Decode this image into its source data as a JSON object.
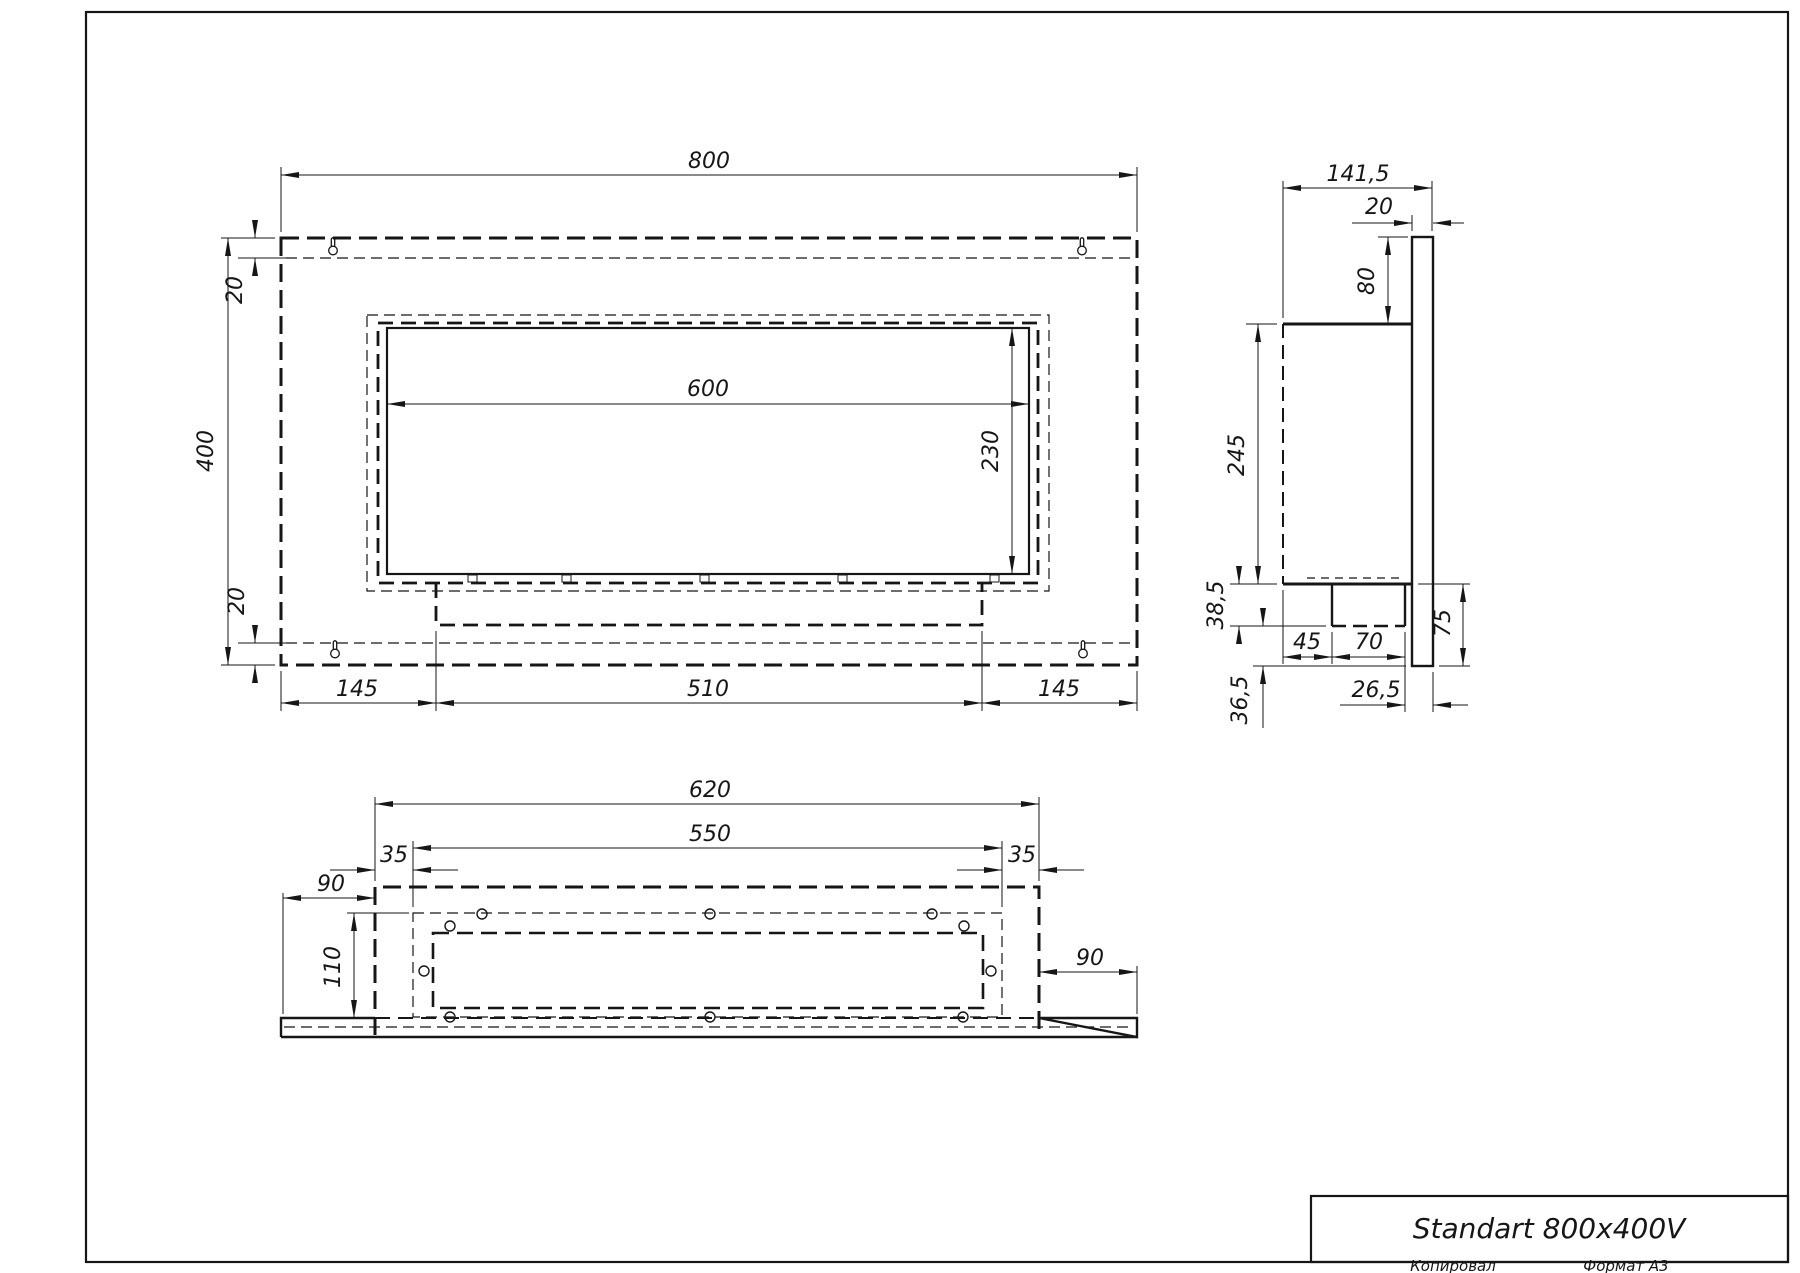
{
  "colors": {
    "line": "#161616",
    "background": "#ffffff"
  },
  "title_block": {
    "name": "Standart 800x400V"
  },
  "footer": {
    "copied_label": "Копировал",
    "format_label": "Формат A3"
  },
  "views": {
    "front": {
      "dims": {
        "overall_width": "800",
        "overall_height": "400",
        "top_offset": "20",
        "bottom_offset": "20",
        "opening_width": "600",
        "opening_height": "230",
        "bottom_left": "145",
        "bottom_center": "510",
        "bottom_right": "145"
      }
    },
    "side": {
      "dims": {
        "overall_depth": "141,5",
        "plate_thickness": "20",
        "plate_above_body": "80",
        "body_height": "245",
        "tray_drop": "38,5",
        "below_tray": "36,5",
        "tray_offset": "45",
        "tray_width": "70",
        "plate_below_body": "75",
        "rear_gap": "26,5"
      }
    },
    "bottom": {
      "dims": {
        "panel_width": "620",
        "slot_width": "550",
        "edge_left": "35",
        "edge_right": "35",
        "wing_left": "90",
        "panel_depth": "110",
        "wing_right": "90"
      }
    }
  }
}
